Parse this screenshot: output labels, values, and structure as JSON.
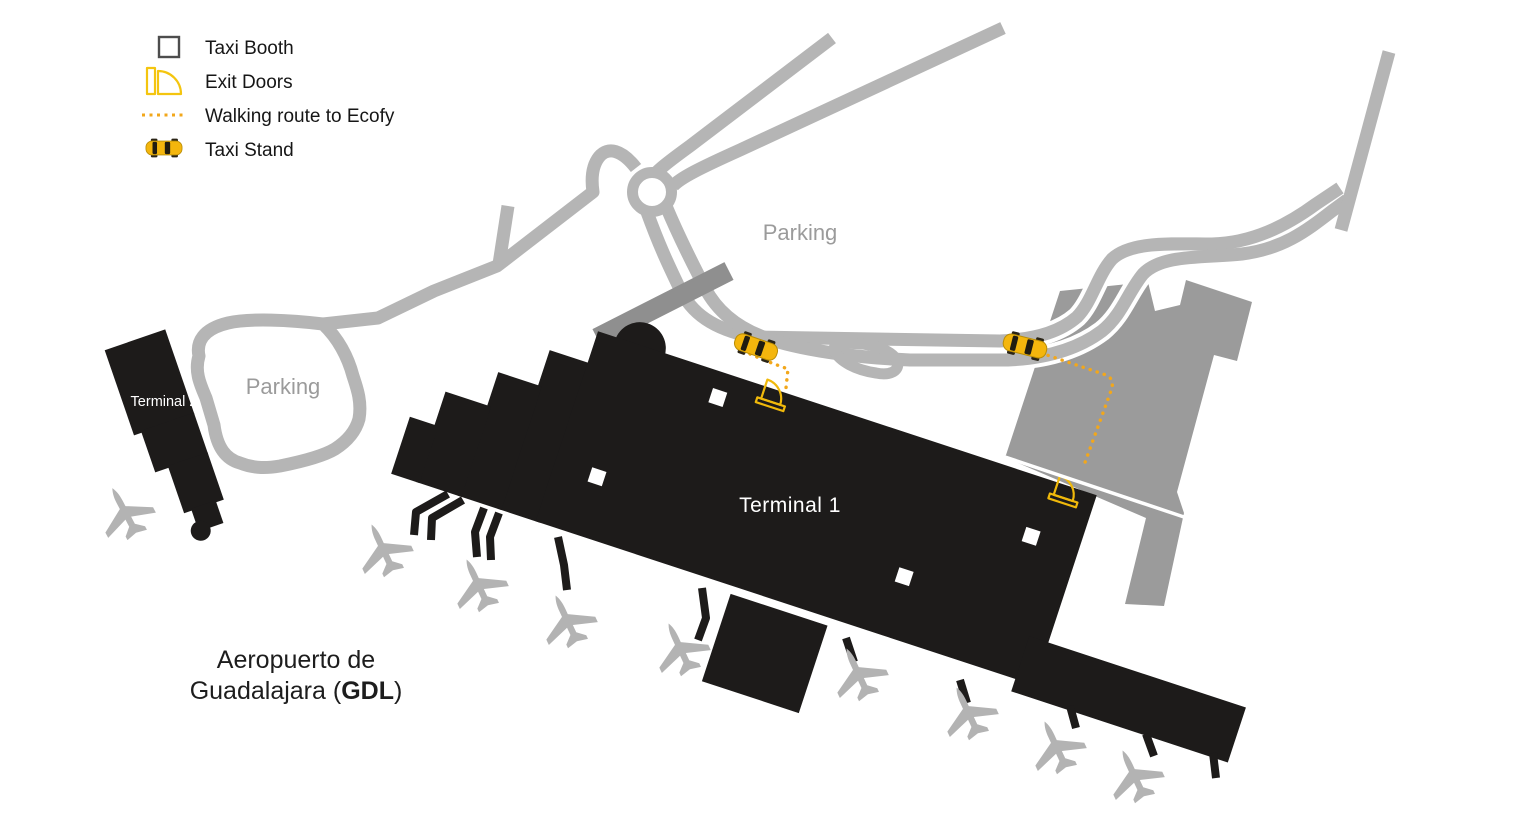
{
  "legend": {
    "items": [
      {
        "icon": "taxi-booth-icon",
        "label": "Taxi Booth"
      },
      {
        "icon": "exit-door-icon",
        "label": "Exit Doors"
      },
      {
        "icon": "walking-route-icon",
        "label": "Walking route to Ecofy"
      },
      {
        "icon": "taxi-stand-icon",
        "label": "Taxi Stand"
      }
    ]
  },
  "labels": {
    "terminal1": "Terminal 1",
    "terminal2": "Terminal 2",
    "parking_top": "Parking",
    "parking_terminal2": "Parking"
  },
  "title": {
    "line1": "Aeropuerto de",
    "line2_prefix": "Guadalajara (",
    "airport_code": "GDL",
    "line2_suffix": ")"
  },
  "map_features": {
    "taxi_stands": 2,
    "exit_doors": 2,
    "taxi_booths": 4,
    "walking_routes": 2,
    "airplanes": 9
  },
  "colors": {
    "terminal_black": "#1d1b1a",
    "road_gray": "#b5b5b5",
    "parking_structure_gray": "#9b9b9b",
    "ramp_gray": "#8f8f8f",
    "taxi_yellow": "#f4b60d",
    "route_orange": "#f2a71b",
    "door_yellow": "#f0b90b",
    "label_gray": "#9b9b9b"
  }
}
